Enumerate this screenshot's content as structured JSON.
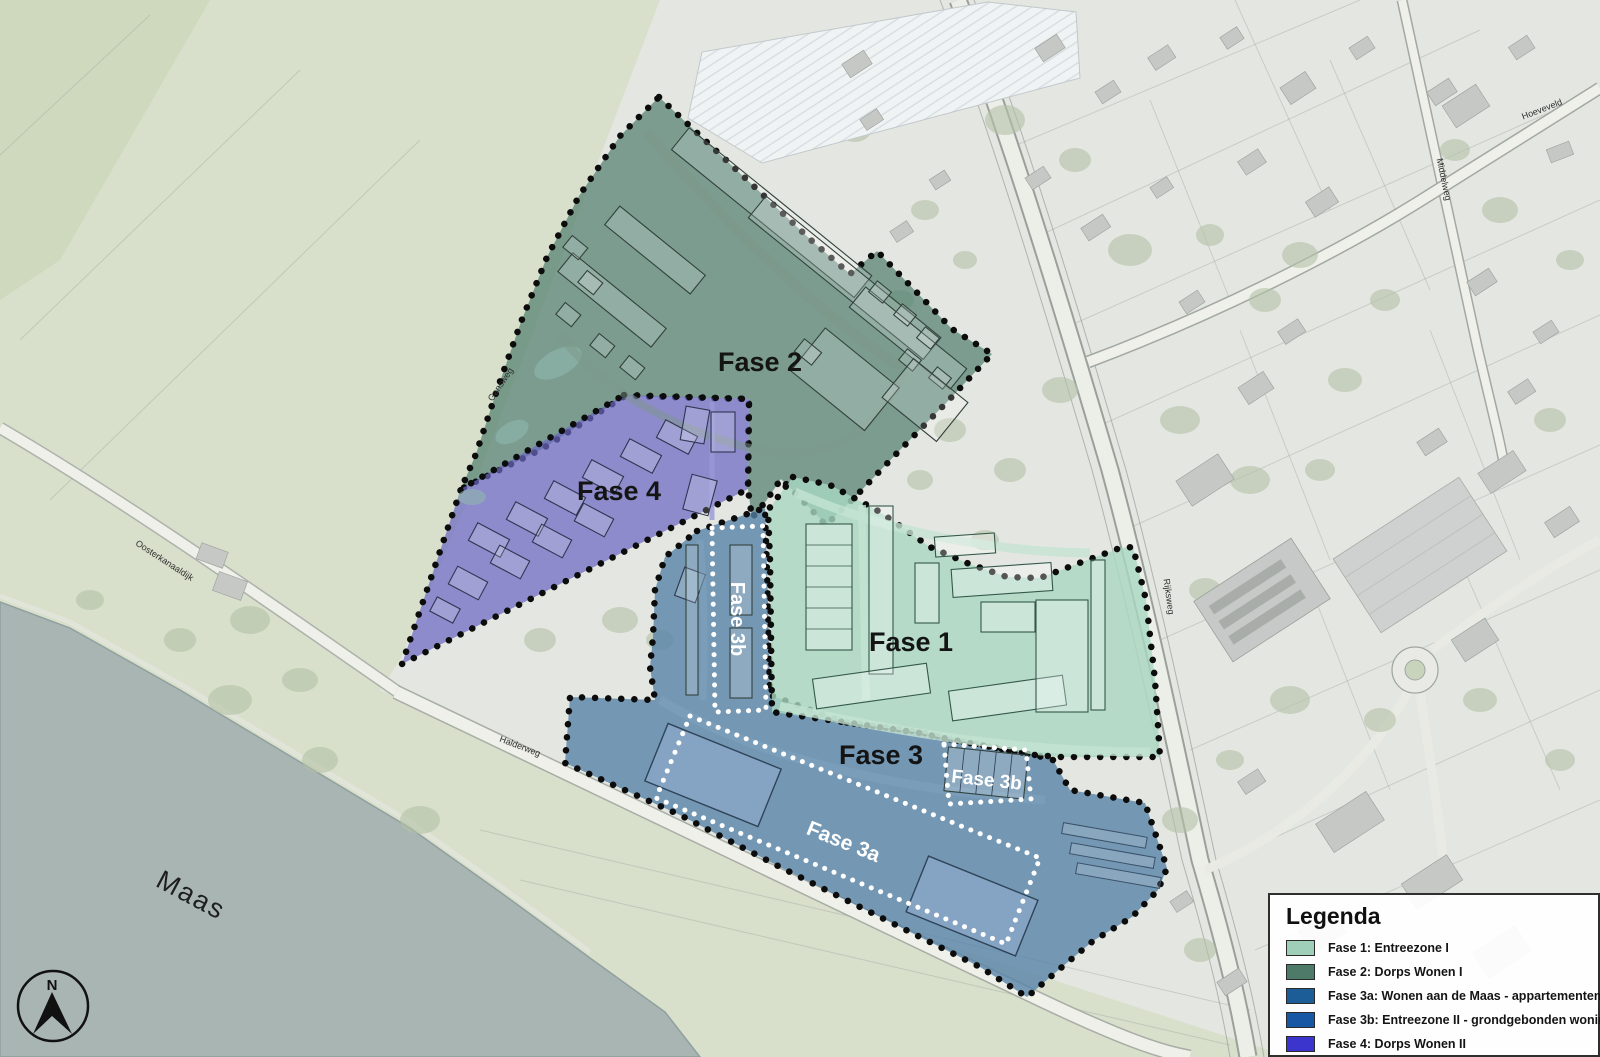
{
  "map": {
    "phases": {
      "fase1": {
        "label": "Fase 1"
      },
      "fase2": {
        "label": "Fase 2"
      },
      "fase3": {
        "label": "Fase 3"
      },
      "fase4": {
        "label": "Fase 4"
      },
      "fase3a": {
        "label": "Fase 3a"
      },
      "fase3b_north": {
        "label": "Fase 3b"
      },
      "fase3b_east": {
        "label": "Fase 3b"
      }
    },
    "streets": {
      "oosterkanaaldijk": "Oosterkanaaldijk",
      "halderweg": "Halderweg",
      "rijksweg": "Rijksweg",
      "middelweg": "Middelweg",
      "hoeveveld": "Hoeveveld",
      "gansweg": "Gansweg"
    },
    "water": "Maas",
    "compass_letter": "N"
  },
  "legend": {
    "title": "Legenda",
    "items": [
      {
        "label": "Fase 1: Entreezone I",
        "color": "#9fceb9"
      },
      {
        "label": "Fase 2: Dorps Wonen I",
        "color": "#4e7a6a"
      },
      {
        "label": "Fase 3a: Wonen aan de Maas - appartementen",
        "color": "#1d5d97"
      },
      {
        "label": "Fase 3b: Entreezone II - grondgebonden woningen (koop)",
        "color": "#1757a3"
      },
      {
        "label": "Fase 4: Dorps Wonen II",
        "color": "#3c35cd"
      }
    ]
  },
  "overlay_colors": {
    "fase1": "#a9d8c2",
    "fase2": "#52806f",
    "fase3": "#5581a6",
    "fase4": "#6b68c2"
  }
}
